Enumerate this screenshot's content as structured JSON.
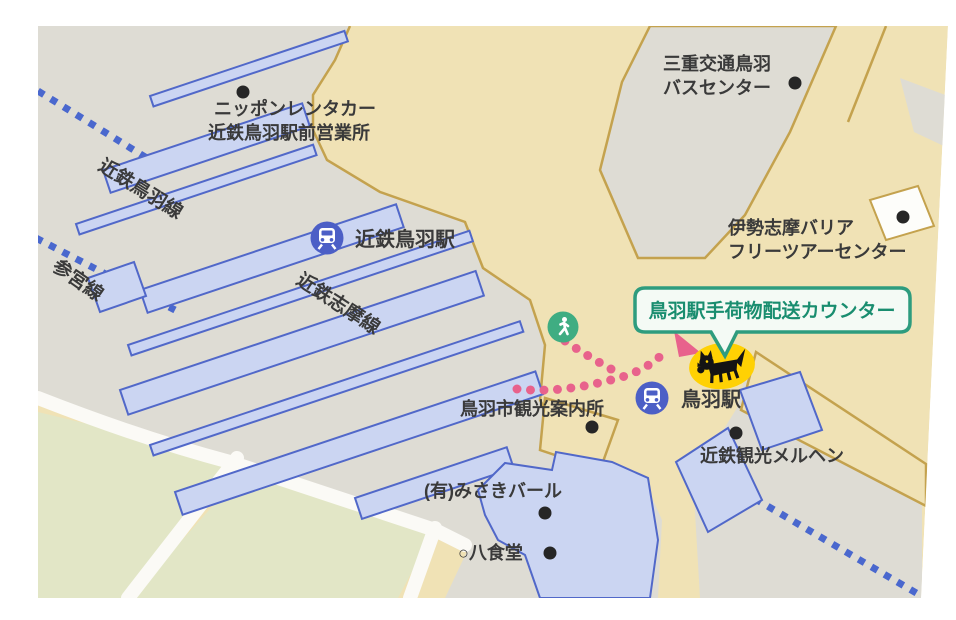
{
  "labels": {
    "rental_car_line1": "ニッポンレンタカー",
    "rental_car_line2": "近鉄鳥羽駅前営業所",
    "bus_center_line1": "三重交通鳥羽",
    "bus_center_line2": "バスセンター",
    "barrier_free_line1": "伊勢志摩バリア",
    "barrier_free_line2": "フリーツアーセンター",
    "kintetsu_toba_line": "近鉄鳥羽線",
    "sangu_line": "参宮線",
    "kintetsu_shima_line": "近鉄志摩線",
    "kintetsu_toba_station": "近鉄鳥羽駅",
    "toba_station": "鳥羽駅",
    "tourist_info": "鳥羽市観光案内所",
    "kintetsu_kanko_merhen": "近鉄観光メルヘン",
    "misaki_bar": "(有)みさきバール",
    "hachi_shokudo": "○八食堂",
    "callout": "鳥羽駅手荷物配送カウンター"
  },
  "icons": {
    "station": "train-in-blue-circle",
    "route_start": "walking-person-in-green-circle",
    "baggage_counter": "black-cat-on-yellow",
    "poi": "black-dot",
    "route": "pink-dotted-path-with-arrow",
    "railway": "blue-dotted-line"
  },
  "colors": {
    "bg": "#ffffff",
    "gray": "#dedcd4",
    "beige": "#f0e2b5",
    "tan": "#c4a24e",
    "green": "#e2e6c6",
    "road": "#fbfaf6",
    "platform": "#cbd5f2",
    "platform-stroke": "#5168c9",
    "rail-dot": "#4a68ce",
    "pink": "#e8628c",
    "callout-border": "#2e9c7e",
    "callout-text": "#198d6f",
    "callout-fill": "#f4faf5",
    "cat-yellow": "#ffd103",
    "station-blue": "#4c5fc6",
    "poi-dot": "#262626",
    "text": "#3a3a3a",
    "marker-green": "#3fad82",
    "building-white": "#fdfdfa"
  }
}
